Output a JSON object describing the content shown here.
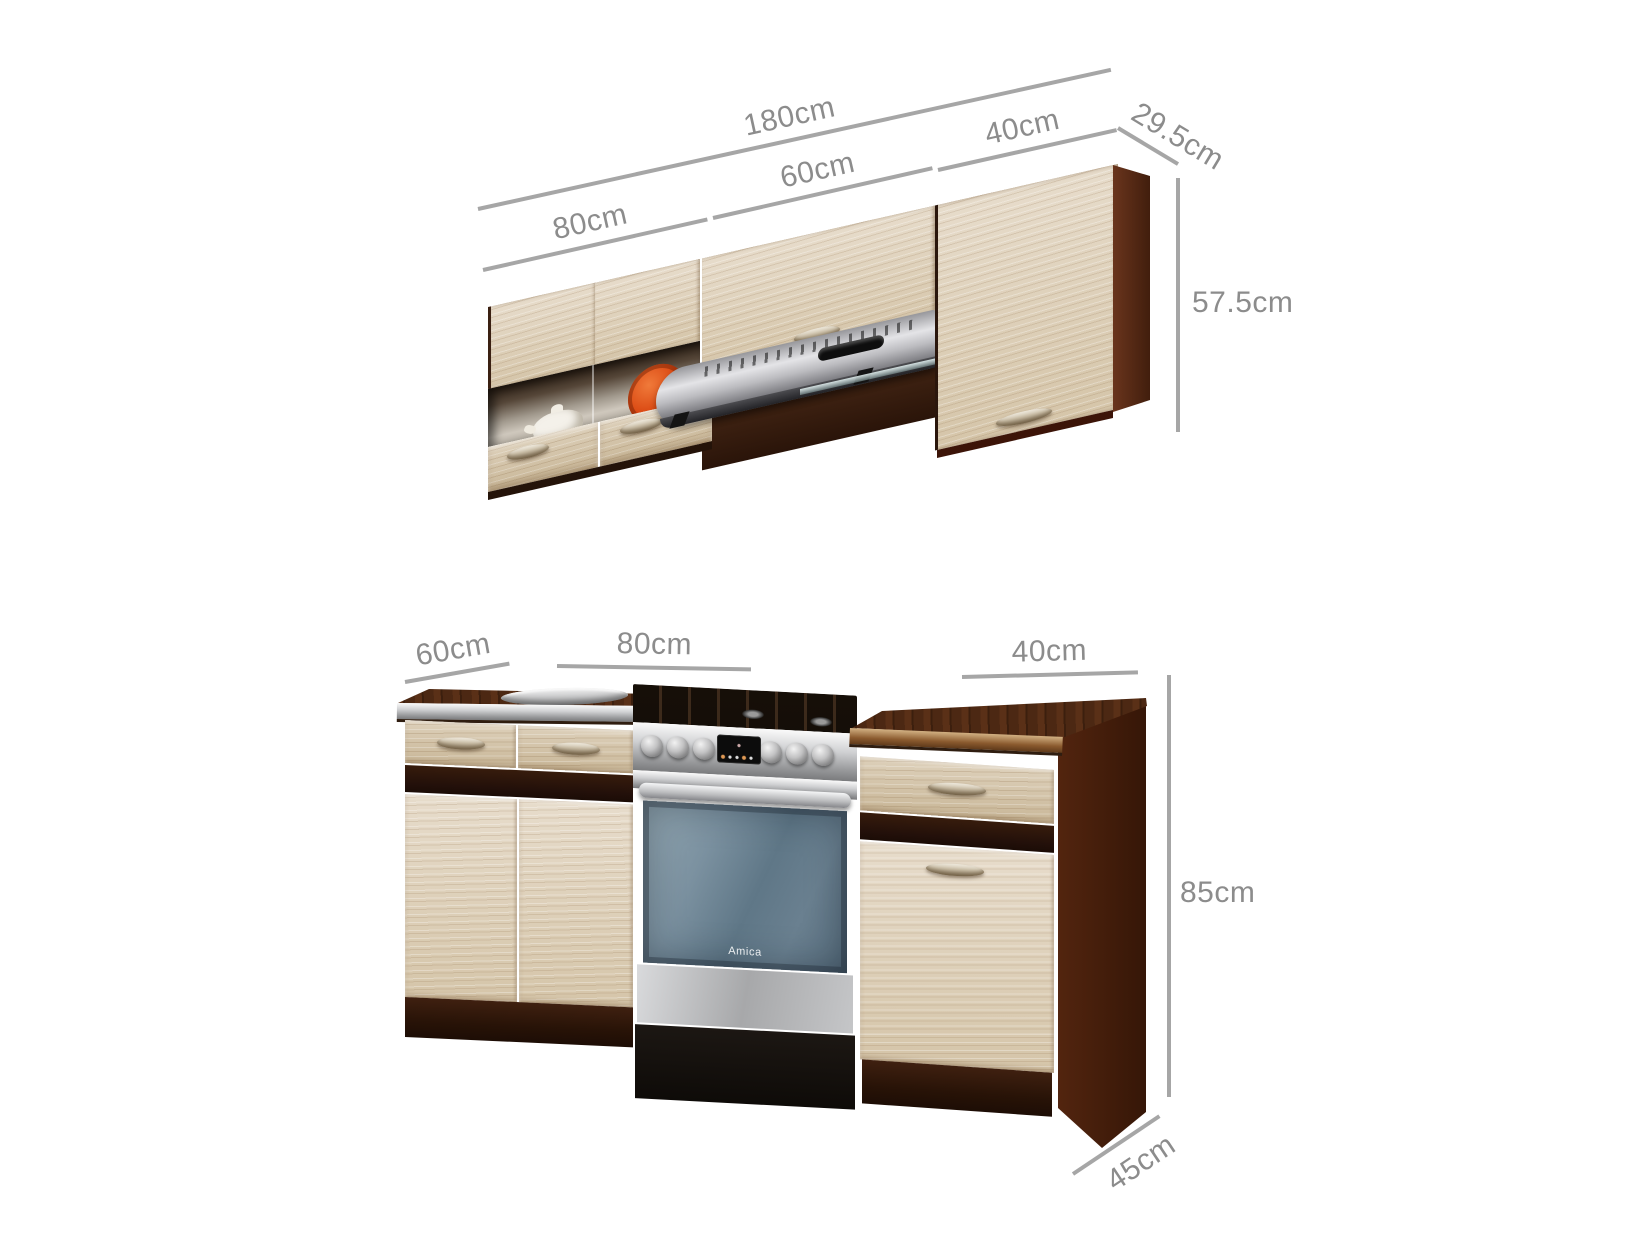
{
  "diagram": {
    "title": "kitchen set dimension diagram",
    "upper_unit": {
      "name": "wall cabinets with cooker hood",
      "dim_total_width": "180cm",
      "dim_left_cabinet": "80cm",
      "dim_middle_cabinet": "60cm",
      "dim_right_cabinet": "40cm",
      "dim_depth": "29.5cm",
      "dim_height": "57.5cm"
    },
    "lower_unit": {
      "name": "base cabinets with cooker",
      "dim_left_cabinet": "60cm",
      "dim_middle_section": "80cm",
      "dim_right_cabinet": "40cm",
      "dim_height": "85cm",
      "dim_depth": "45cm",
      "oven_brand": "Amica"
    },
    "colors": {
      "dimension_line": "#a6a6a6",
      "dimension_text": "#8c8c8c",
      "wood_light": "#dccfb8",
      "wood_dark_wenge": "#2a1507",
      "countertop_dark": "#4a2713",
      "stainless_steel": "#c3c4c6",
      "oven_glass": "#6d8494",
      "accent_dish_orange": "#d8440f"
    }
  }
}
